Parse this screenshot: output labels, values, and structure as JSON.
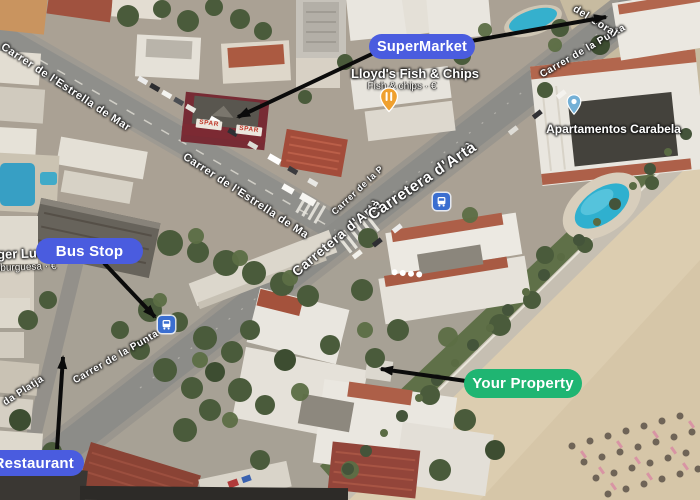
{
  "annotations": {
    "supermarket": {
      "label": "SuperMarket",
      "color": "#4a5cdf"
    },
    "bus_stop": {
      "label": "Bus Stop",
      "color": "#4a5cdf"
    },
    "your_property": {
      "label": "Your Property",
      "color": "#1fb572"
    },
    "restaurant": {
      "label": "Restaurant",
      "color": "#4a5cdf"
    }
  },
  "pois": {
    "fish_and_chips": {
      "name": "Lloyd's Fish & Chips",
      "subtitle": "Fish & chips · €",
      "icon": "restaurant-pin",
      "pin_color": "#efa02f"
    },
    "carabela": {
      "name": "Apartamentos Carabela",
      "icon": "lodging-pin",
      "pin_color": "#74b0d6"
    },
    "burger": {
      "name": "rger Luna",
      "subtitle": "mburguesa · €"
    },
    "spar_store": {
      "name": "SPAR"
    },
    "bus_stop_icon": {
      "icon": "bus-stop-icon",
      "color": "#3a6ed0"
    }
  },
  "streets": {
    "estrella_a": "Carrer de l'Estrella de Mar",
    "estrella_b": "Carrer de l'Estrella de Ma",
    "punta_top": "Carrer de la Punta",
    "punta_junction": "Carrer de la P",
    "punta_bottom": "Carrer de la Punta",
    "arta_lower": "Carretera d'Artà",
    "arta_upper": "Carretera d'Artà",
    "coral": "del Coral",
    "platja": "da Platja"
  }
}
